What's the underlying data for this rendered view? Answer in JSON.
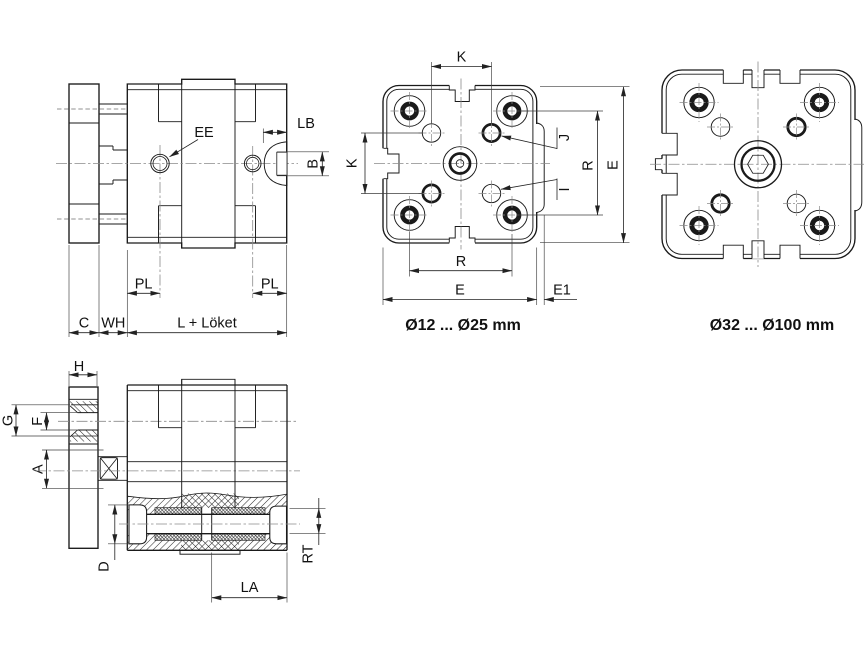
{
  "page": {
    "background": "#ffffff"
  },
  "colors": {
    "line": "#1a1a1a",
    "dimension": "#222222",
    "centerline": "#8a8a8a",
    "text": "#111111"
  },
  "views": {
    "side": {
      "labels": {
        "ee": "EE",
        "lb": "LB",
        "b": "B",
        "pl_left": "PL",
        "pl_right": "PL",
        "c": "C",
        "wh": "WH",
        "stroke_length": "L + Löket"
      }
    },
    "face_small": {
      "caption": "Ø12 ... Ø25 mm",
      "labels": {
        "k_top": "K",
        "k_left": "K",
        "j": "J",
        "i": "I",
        "r_right": "R",
        "e_right": "E",
        "r_bottom": "R",
        "e_bottom": "E",
        "e1": "E1"
      }
    },
    "face_large": {
      "caption": "Ø32 ... Ø100 mm"
    },
    "section": {
      "labels": {
        "h": "H",
        "g": "G",
        "f": "F",
        "a": "A",
        "d": "D",
        "la": "LA",
        "rt": "RT"
      }
    }
  }
}
